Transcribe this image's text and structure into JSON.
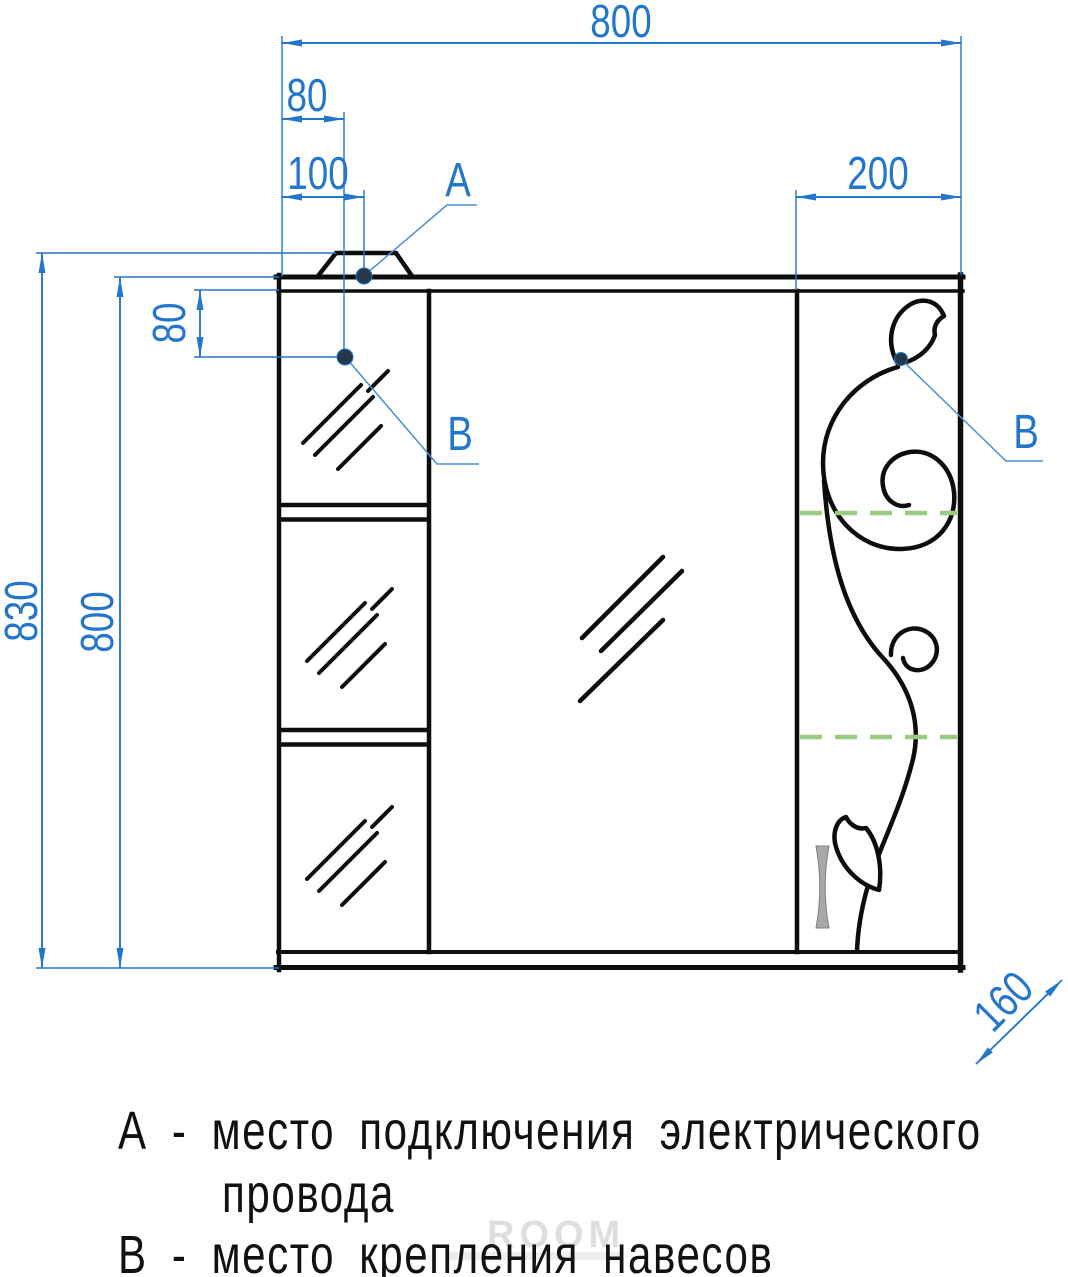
{
  "colors": {
    "dimension_blue": "#2376cb",
    "leader_blue": "#4b8fd5",
    "shelf_dash_green": "#98cc83",
    "drawing_black": "#0d0d0d",
    "handle_gray": "#a8a8a8",
    "marker_dark": "#24384a"
  },
  "dimensions": {
    "overall_width": "800",
    "lamp_center_offset": "80",
    "point_a_offset": "100",
    "door_width": "200",
    "overall_height": "830",
    "cabinet_height": "800",
    "point_b_drop": "80",
    "depth": "160"
  },
  "callouts": {
    "a": "А",
    "b_left": "В",
    "b_right": "В"
  },
  "legend": {
    "line1": "А - место подключения электрического",
    "line2": "провода",
    "line3": "В - место крепления навесов"
  },
  "watermark": "ROOM"
}
